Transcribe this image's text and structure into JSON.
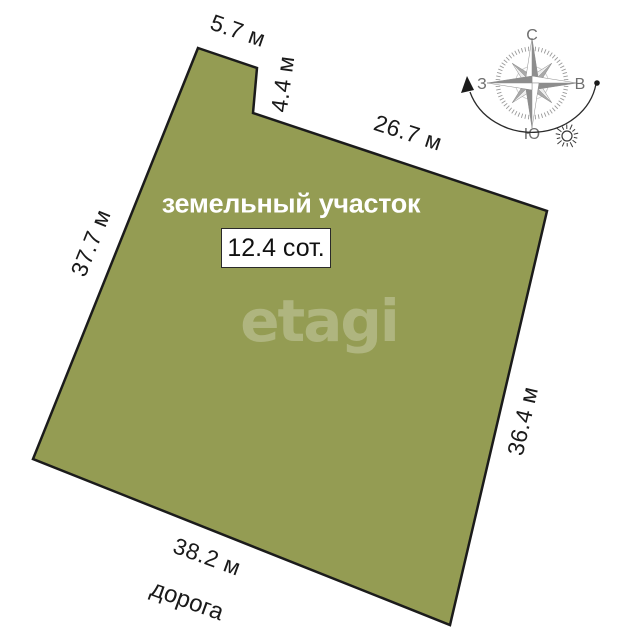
{
  "plot": {
    "title": "земельный участок",
    "area": "12.4 сот.",
    "watermark": "etagi",
    "fill_color": "#949C53",
    "outline_color": "#1B1B1B"
  },
  "dimensions": {
    "top_left": "5.7 м",
    "notch": "4.4 м",
    "top": "26.7 м",
    "left": "37.7 м",
    "right": "36.4 м",
    "bottom": "38.2 м"
  },
  "road_label": "дорога",
  "compass": {
    "north": "С",
    "south": "Ю",
    "west": "З",
    "east": "В"
  }
}
